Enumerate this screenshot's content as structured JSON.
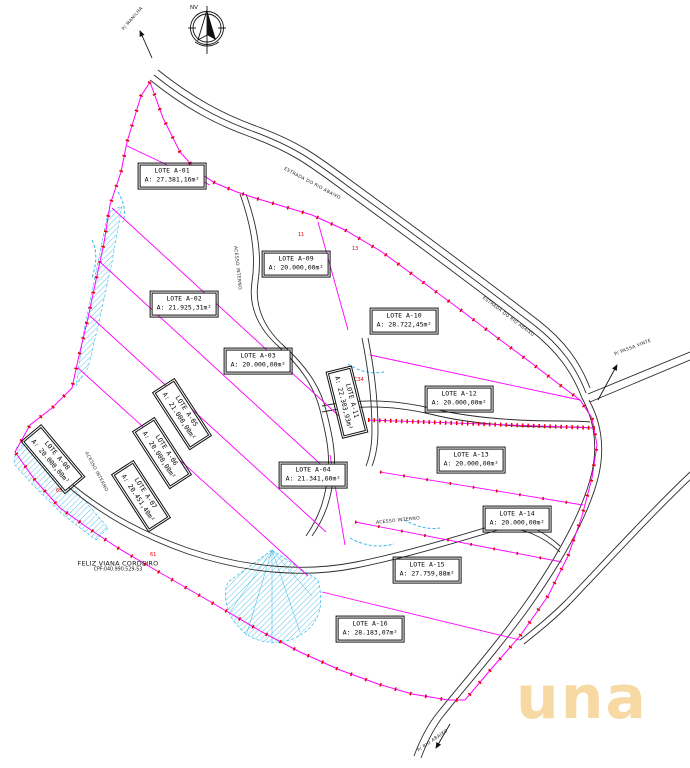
{
  "compass": {
    "label": "NV"
  },
  "owner": {
    "name": "FELIZ VIANA CORDEIRO",
    "cpf": "CPF:040.990.529-53"
  },
  "logo": {
    "text": "una"
  },
  "lots": [
    {
      "name": "LOTE A-01",
      "area": "A: 27.381,16m²"
    },
    {
      "name": "LOTE A-02",
      "area": "A: 21.925,31m²"
    },
    {
      "name": "LOTE A-03",
      "area": "A: 20.000,00m²"
    },
    {
      "name": "LOTE A-04",
      "area": "A: 21.341,60m²"
    },
    {
      "name": "LOTE A-05",
      "area": "A: 21.000,00m²"
    },
    {
      "name": "LOTE A-06",
      "area": "A: 20.000,00m²"
    },
    {
      "name": "LOTE A-07",
      "area": "A: 20.451,40m²"
    },
    {
      "name": "LOTE A-08",
      "area": "A: 20.000,00m²"
    },
    {
      "name": "LOTE A-09",
      "area": "A: 20.000,00m²"
    },
    {
      "name": "LOTE A-10",
      "area": "A: 28.722,45m²"
    },
    {
      "name": "LOTE A-11",
      "area": "A: 22.303,93m²"
    },
    {
      "name": "LOTE A-12",
      "area": "A: 20.000,00m²"
    },
    {
      "name": "LOTE A-13",
      "area": "A: 20.000,00m²"
    },
    {
      "name": "LOTE A-14",
      "area": "A: 20.000,00m²"
    },
    {
      "name": "LOTE A-15",
      "area": "A: 27.759,88m²"
    },
    {
      "name": "LOTE A-16",
      "area": "A: 28.183,07m²"
    }
  ],
  "road_labels": {
    "to_north": "P/ MANILHA",
    "to_east": "P/ PASSA VINTE",
    "to_south": "P/ RIO ABAIXO",
    "main_road_1": "ESTRADA DO RIO ABAIXO",
    "main_road_2": "ESTRADA DO RIO ABAIXO",
    "internal_1": "ACESSO INTERNO",
    "internal_2": "ACESSO INTERNO",
    "internal_3": "ACESSO INTERNO"
  },
  "point_labels": [
    {
      "text": "11",
      "x": 298,
      "y": 236
    },
    {
      "text": "13",
      "x": 352,
      "y": 250
    },
    {
      "text": "C34",
      "x": 354,
      "y": 381
    },
    {
      "text": "61",
      "x": 150,
      "y": 556
    },
    {
      "text": "65",
      "x": 56,
      "y": 492
    }
  ],
  "colors": {
    "boundary": "#ff00ff",
    "markers": "#e60000",
    "water": "#35b6e6",
    "road": "#2b2b2b",
    "logo": "#f7d9a4"
  }
}
